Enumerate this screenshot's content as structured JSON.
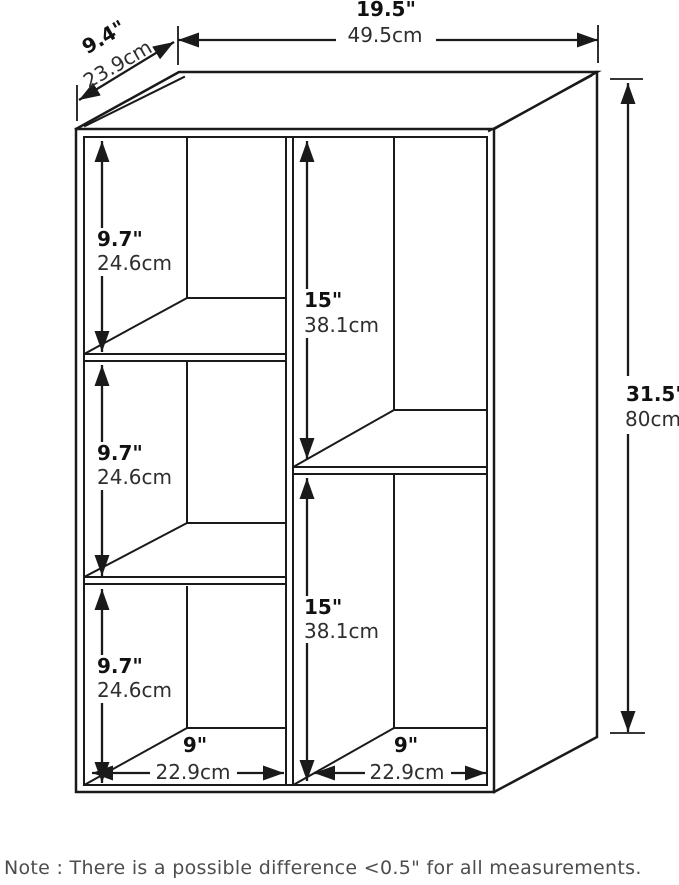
{
  "colors": {
    "line": "#1a1a1a",
    "inches_text": "#111111",
    "cm_text": "#2e2e2e",
    "note_text": "#4d4d4d",
    "background": "#ffffff"
  },
  "dimensions": {
    "overall_width": {
      "inches": "19.5\"",
      "cm": "49.5cm"
    },
    "overall_depth": {
      "inches": "9.4\"",
      "cm": "23.9cm"
    },
    "overall_height": {
      "inches": "31.5\"",
      "cm": "80cm"
    },
    "left_compartment_height": {
      "inches": "9.7\"",
      "cm": "24.6cm"
    },
    "right_compartment_height": {
      "inches": "15\"",
      "cm": "38.1cm"
    },
    "compartment_width": {
      "inches": "9\"",
      "cm": "22.9cm"
    }
  },
  "note": "Note : There is a possible difference <0.5\" for all measurements."
}
